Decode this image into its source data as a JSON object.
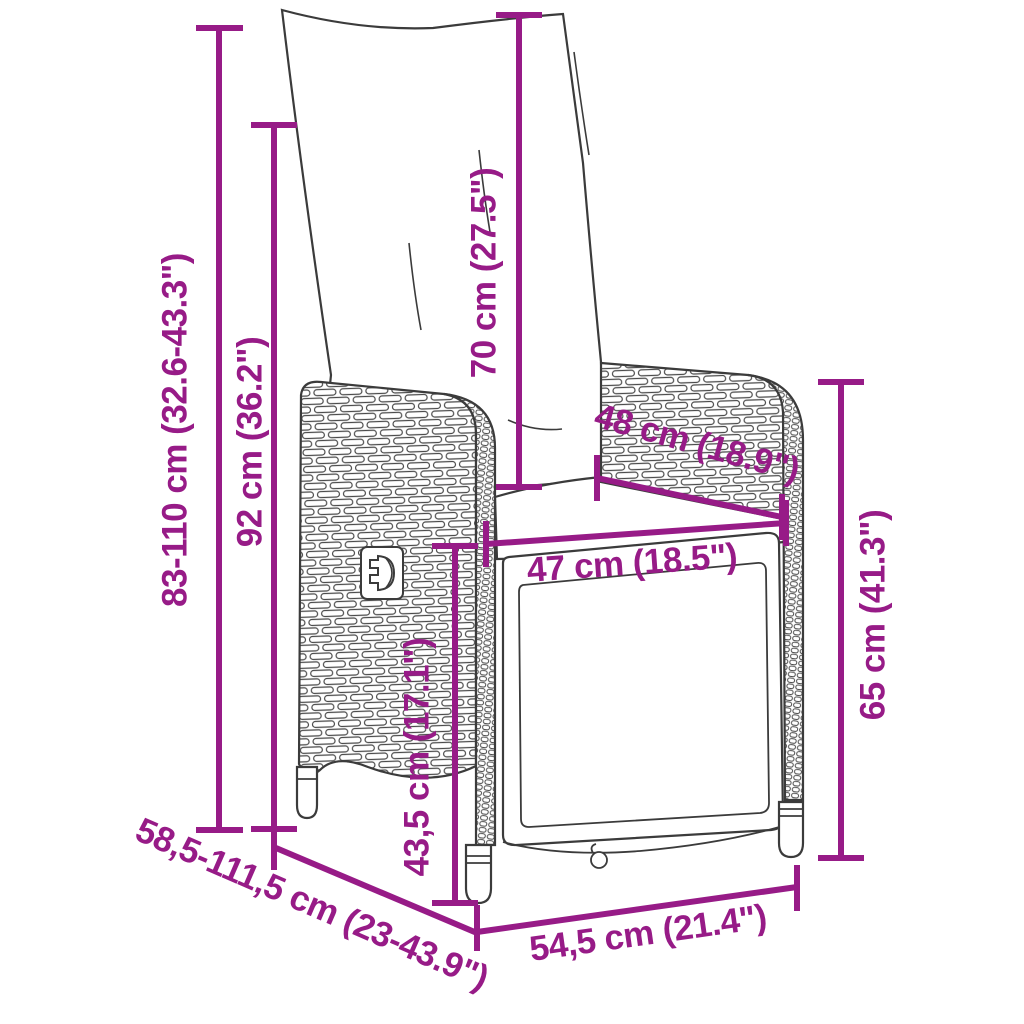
{
  "diagram": {
    "type": "product-dimension-diagram",
    "subject": "reclining rattan garden chair with cushions",
    "background_color": "#ffffff",
    "accent_color": "#971B87",
    "line_art_color": "#3b3b3b",
    "labels": {
      "overall_height_range": "83-110 cm (32.6-43.3\")",
      "backrest_height": "92 cm (36.2\")",
      "back_cushion_height": "70 cm (27.5\")",
      "armrest_depth": "48 cm (18.9\")",
      "seat_width": "47 cm (18.5\")",
      "seat_height": "43,5 cm (17.1\")",
      "side_height": "65 cm (41.3\")",
      "overall_depth_range": "58,5-111,5 cm (23-43.9\")",
      "base_width": "54,5 cm (21.4\")"
    }
  }
}
